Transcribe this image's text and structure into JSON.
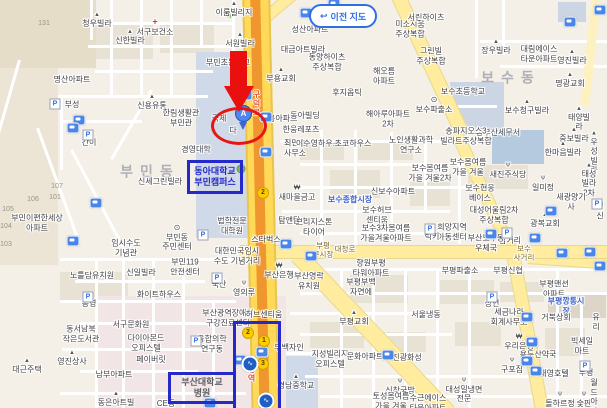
{
  "map": {
    "button": {
      "label": "이전 지도",
      "icon": "undo-arrow"
    },
    "annotations": {
      "marker_letter": "A",
      "box_donga": {
        "text": "동아대학교\n부민캠퍼스"
      },
      "box_hospital": {
        "text": "부산대학교\n병원"
      },
      "road_text_top": "구덕로",
      "road_text_bottom": "토성역"
    },
    "colors": {
      "highlight_blue": "#2629c9",
      "annotation_red": "#e81515",
      "metro_line_orange": "#f0962e",
      "road_yellow": "#ffe87f",
      "market_blue": "#3f63c8",
      "bus_icon_blue": "#4a86e8"
    },
    "labels": [
      {
        "t": "131",
        "x": 44,
        "y": 24,
        "s": "tiny"
      },
      {
        "t": "이룸빌리지",
        "x": 234,
        "y": 9,
        "ic": "villa"
      },
      {
        "t": "청우빌라",
        "x": 97,
        "y": 20,
        "ic": "villa"
      },
      {
        "t": "서구보건소",
        "x": 155,
        "y": 27,
        "ic": "clinic"
      },
      {
        "t": "신한빌라",
        "x": 130,
        "y": 37,
        "ic": "villa"
      },
      {
        "t": "서원빌라",
        "x": 240,
        "y": 40,
        "ic": "villa"
      },
      {
        "t": "성산아파트",
        "x": 310,
        "y": 30
      },
      {
        "t": "대금아트빌라",
        "x": 303,
        "y": 50
      },
      {
        "t": "미소지움\n주상복합",
        "x": 410,
        "y": 29
      },
      {
        "t": "서린하이츠",
        "x": 426,
        "y": 18
      },
      {
        "t": "그린빌\n주상복합",
        "x": 431,
        "y": 56
      },
      {
        "t": "장우빌라",
        "x": 496,
        "y": 47,
        "ic": "villa"
      },
      {
        "t": "대림에이스\n타운아파트",
        "x": 539,
        "y": 54
      },
      {
        "t": "영진빌라",
        "x": 572,
        "y": 57,
        "ic": "villa"
      },
      {
        "t": "동양하이츠\n주상복합",
        "x": 327,
        "y": 62
      },
      {
        "t": "부민초등학교",
        "x": 228,
        "y": 63
      },
      {
        "t": "부용교회",
        "x": 281,
        "y": 75,
        "ic": "villa"
      },
      {
        "t": "명산아파트",
        "x": 72,
        "y": 80
      },
      {
        "t": "해오름\n아파트",
        "x": 384,
        "y": 76
      },
      {
        "t": "보수동",
        "x": 511,
        "y": 78,
        "s": "area"
      },
      {
        "t": "명광교회",
        "x": 570,
        "y": 80,
        "ic": "villa"
      },
      {
        "t": "후지옵틱",
        "x": 347,
        "y": 93
      },
      {
        "t": "보수초등학교",
        "x": 463,
        "y": 92
      },
      {
        "t": "부성",
        "x": 72,
        "y": 105
      },
      {
        "t": "신용유통",
        "x": 152,
        "y": 102,
        "ic": "villa"
      },
      {
        "t": "보수파출소",
        "x": 434,
        "y": 105,
        "ic": "office"
      },
      {
        "t": "보수청구빌라",
        "x": 527,
        "y": 107,
        "ic": "villa"
      },
      {
        "t": "한림생활관\n부민관",
        "x": 181,
        "y": 118
      },
      {
        "t": "국제",
        "x": 219,
        "y": 119
      },
      {
        "t": "부용아파트",
        "x": 279,
        "y": 119
      },
      {
        "t": "동아빌딩",
        "x": 305,
        "y": 116
      },
      {
        "t": "태양빌라",
        "x": 579,
        "y": 119,
        "ic": "villa"
      },
      {
        "t": "해아루아파트\n2차",
        "x": 388,
        "y": 119
      },
      {
        "t": "다",
        "x": 233,
        "y": 131
      },
      {
        "t": "한웅레포츠",
        "x": 301,
        "y": 130
      },
      {
        "t": "중보빌라",
        "x": 574,
        "y": 135,
        "ic": "villa"
      },
      {
        "t": "중부산세무서",
        "x": 498,
        "y": 133
      },
      {
        "t": "송파지오스3\n빌라트주상복합",
        "x": 466,
        "y": 136
      },
      {
        "t": "간이",
        "x": 89,
        "y": 143
      },
      {
        "t": "최만호\n사무소",
        "x": 295,
        "y": 148
      },
      {
        "t": "이수영하우스",
        "x": 318,
        "y": 144
      },
      {
        "t": "초코하우스",
        "x": 353,
        "y": 144
      },
      {
        "t": "노인생활과학\n연구소",
        "x": 411,
        "y": 145
      },
      {
        "t": "한마음빌라",
        "x": 563,
        "y": 149,
        "ic": "villa"
      },
      {
        "t": "경영대학",
        "x": 196,
        "y": 150
      },
      {
        "t": "우성빌라",
        "x": 594,
        "y": 153,
        "ic": "villa"
      },
      {
        "t": "부민동",
        "x": 150,
        "y": 172,
        "s": "area"
      },
      {
        "t": "신세그린빌라",
        "x": 160,
        "y": 182
      },
      {
        "t": "보수봄여름\n가을 겨울2차",
        "x": 430,
        "y": 173
      },
      {
        "t": "보수봄여름\n가을 겨울",
        "x": 468,
        "y": 167
      },
      {
        "t": "새진주식당",
        "x": 508,
        "y": 171,
        "ic": "rest"
      },
      {
        "t": "태성빌라2차",
        "x": 589,
        "y": 180,
        "ic": "villa"
      },
      {
        "t": "일미정",
        "x": 543,
        "y": 184,
        "ic": "rest"
      },
      {
        "t": "새마을금고",
        "x": 297,
        "y": 193,
        "ic": "bank"
      },
      {
        "t": "신보수아파트",
        "x": 393,
        "y": 192
      },
      {
        "t": "보수현웅\n베이스",
        "x": 480,
        "y": 193
      },
      {
        "t": "보수종합시장",
        "x": 350,
        "y": 200,
        "s": "blue"
      },
      {
        "t": "새광양기사",
        "x": 571,
        "y": 202
      },
      {
        "t": "청신",
        "x": 600,
        "y": 211
      },
      {
        "t": "보수허브\n센티움",
        "x": 377,
        "y": 215
      },
      {
        "t": "대성어울림2차\n주상복합",
        "x": 494,
        "y": 215
      },
      {
        "t": "탐앤탐스",
        "x": 293,
        "y": 221
      },
      {
        "t": "광복교회",
        "x": 545,
        "y": 220,
        "ic": "villa"
      },
      {
        "t": "법학전문\n대학원",
        "x": 232,
        "y": 226
      },
      {
        "t": "브리지스톤\n타이어",
        "x": 314,
        "y": 227
      },
      {
        "t": "부민이편한세상\n아파트",
        "x": 37,
        "y": 223
      },
      {
        "t": "107",
        "x": 57,
        "y": 187,
        "s": "tiny"
      },
      {
        "t": "101",
        "x": 55,
        "y": 198,
        "s": "tiny"
      },
      {
        "t": "106",
        "x": 33,
        "y": 200,
        "s": "tiny"
      },
      {
        "t": "105",
        "x": 8,
        "y": 210,
        "s": "tiny"
      },
      {
        "t": "104",
        "x": 6,
        "y": 227,
        "s": "tiny"
      },
      {
        "t": "103",
        "x": 6,
        "y": 245,
        "s": "tiny"
      },
      {
        "t": "보수3차봄여름\n가을겨울아파트",
        "x": 386,
        "y": 233
      },
      {
        "t": "희망지역\n아동센터",
        "x": 452,
        "y": 232
      },
      {
        "t": "럭키",
        "x": 432,
        "y": 237
      },
      {
        "t": "부민동\n주민센터",
        "x": 177,
        "y": 238,
        "ic": "office"
      },
      {
        "t": "삼거리",
        "x": 510,
        "y": 241
      },
      {
        "t": "스타벅스",
        "x": 266,
        "y": 240
      },
      {
        "t": "부산보수동\n우체국",
        "x": 486,
        "y": 243
      },
      {
        "t": "대청로",
        "x": 345,
        "y": 249,
        "s": "road"
      },
      {
        "t": "부평\n구시장",
        "x": 323,
        "y": 250,
        "s": "road"
      },
      {
        "t": "임시수도\n기념관",
        "x": 126,
        "y": 248
      },
      {
        "t": "보수\n사거리",
        "x": 524,
        "y": 253,
        "s": "road"
      },
      {
        "t": "대한민국임시\n수도 기념거리",
        "x": 237,
        "y": 256
      },
      {
        "t": "향원부평\n타워아파트",
        "x": 371,
        "y": 268
      },
      {
        "t": "부민119\n안전센터",
        "x": 185,
        "y": 267
      },
      {
        "t": "부산은행",
        "x": 279,
        "y": 271,
        "ic": "bank"
      },
      {
        "t": "부평파출소",
        "x": 460,
        "y": 271
      },
      {
        "t": "부평신협",
        "x": 508,
        "y": 271
      },
      {
        "t": "노틀담유치원",
        "x": 92,
        "y": 276
      },
      {
        "t": "신일빌라",
        "x": 141,
        "y": 273
      },
      {
        "t": "부산영락\n유치원",
        "x": 309,
        "y": 281
      },
      {
        "t": "국산",
        "x": 219,
        "y": 285
      },
      {
        "t": "영의루",
        "x": 244,
        "y": 289,
        "ic": "rest"
      },
      {
        "t": "부평부백\n자연에",
        "x": 361,
        "y": 287
      },
      {
        "t": "부평맨션\n아파트",
        "x": 554,
        "y": 289
      },
      {
        "t": "화이트하우스",
        "x": 159,
        "y": 295
      },
      {
        "t": "공영",
        "x": 89,
        "y": 304
      },
      {
        "t": "상언",
        "x": 492,
        "y": 304
      },
      {
        "t": "부평깡통시장",
        "x": 566,
        "y": 306,
        "s": "blue"
      },
      {
        "t": "부산광역장애인\n구강진료센터",
        "x": 228,
        "y": 318
      },
      {
        "t": "허브센티움",
        "x": 264,
        "y": 315
      },
      {
        "t": "부평교회",
        "x": 354,
        "y": 318,
        "ic": "villa"
      },
      {
        "t": "서울냉동",
        "x": 426,
        "y": 315
      },
      {
        "t": "세금나라\n회계사무소",
        "x": 509,
        "y": 317
      },
      {
        "t": "거북상회",
        "x": 556,
        "y": 318
      },
      {
        "t": "유리",
        "x": 596,
        "y": 322
      },
      {
        "t": "서구문화원",
        "x": 131,
        "y": 325
      },
      {
        "t": "동서남북\n작은도서관",
        "x": 81,
        "y": 334
      },
      {
        "t": "다이아몬드\n오피스텔",
        "x": 146,
        "y": 343
      },
      {
        "t": "융합의학\n연구동",
        "x": 212,
        "y": 344
      },
      {
        "t": "부백자인",
        "x": 289,
        "y": 348
      },
      {
        "t": "우리은행",
        "x": 519,
        "y": 342,
        "ic": "bank"
      },
      {
        "t": "빅세일마트",
        "x": 582,
        "y": 346
      },
      {
        "t": "영진상사",
        "x": 72,
        "y": 358,
        "ic": "villa"
      },
      {
        "t": "페이버릿",
        "x": 151,
        "y": 360
      },
      {
        "t": "지성빌리지\n오피스텔",
        "x": 330,
        "y": 359
      },
      {
        "t": "문화아파트",
        "x": 365,
        "y": 357
      },
      {
        "t": "진광화성",
        "x": 407,
        "y": 358
      },
      {
        "t": "용두산약국",
        "x": 538,
        "y": 355
      },
      {
        "t": "구포집",
        "x": 512,
        "y": 366,
        "ic": "rest"
      },
      {
        "t": "남부아파트",
        "x": 114,
        "y": 375
      },
      {
        "t": "대근주택",
        "x": 27,
        "y": 366,
        "ic": "villa"
      },
      {
        "t": "대영호텔",
        "x": 554,
        "y": 374
      },
      {
        "t": "부평",
        "x": 586,
        "y": 373
      },
      {
        "t": "경남중학교",
        "x": 296,
        "y": 382,
        "ic": "villa"
      },
      {
        "t": "신창국밥",
        "x": 400,
        "y": 387,
        "ic": "rest"
      },
      {
        "t": "대성밀냉면\n전문",
        "x": 464,
        "y": 391,
        "ic": "rest"
      },
      {
        "t": "동은아트빌",
        "x": 116,
        "y": 399,
        "ic": "villa"
      },
      {
        "t": "CE동",
        "x": 166,
        "y": 404
      },
      {
        "t": "토성봄여름\n가을 겨울",
        "x": 391,
        "y": 401
      },
      {
        "t": "수근에이스\n타운아파트",
        "x": 428,
        "y": 403
      },
      {
        "t": "돌하르정",
        "x": 560,
        "y": 400,
        "ic": "rest"
      },
      {
        "t": "숯판",
        "x": 584,
        "y": 400,
        "ic": "rest"
      },
      {
        "t": "월드\n아파트",
        "x": 594,
        "y": 402
      }
    ],
    "icons": {
      "bus_stops": [
        [
          306,
          13
        ],
        [
          334,
          4
        ],
        [
          570,
          22
        ],
        [
          600,
          10
        ],
        [
          246,
          95
        ],
        [
          266,
          117
        ],
        [
          266,
          152
        ],
        [
          79,
          120
        ],
        [
          73,
          128
        ],
        [
          96,
          203
        ],
        [
          73,
          241
        ],
        [
          286,
          244
        ],
        [
          311,
          256
        ],
        [
          491,
          234
        ],
        [
          535,
          238
        ],
        [
          590,
          252
        ],
        [
          551,
          211
        ],
        [
          562,
          253
        ],
        [
          600,
          266
        ],
        [
          388,
          355
        ],
        [
          527,
          317
        ],
        [
          532,
          342
        ],
        [
          536,
          371
        ],
        [
          262,
          352
        ],
        [
          240,
          360
        ],
        [
          210,
          403
        ],
        [
          527,
          361
        ]
      ],
      "parking": [
        [
          55,
          104
        ],
        [
          88,
          135
        ],
        [
          88,
          297
        ],
        [
          217,
          278
        ],
        [
          203,
          235
        ],
        [
          196,
          341
        ],
        [
          430,
          229
        ],
        [
          492,
          297
        ],
        [
          507,
          233
        ],
        [
          597,
          204
        ],
        [
          585,
          366
        ]
      ],
      "subway_exits": [
        {
          "n": "2",
          "x": 263,
          "y": 193
        },
        {
          "n": "2",
          "x": 248,
          "y": 333
        },
        {
          "n": "1",
          "x": 264,
          "y": 341
        },
        {
          "n": "3",
          "x": 263,
          "y": 364
        }
      ],
      "metro_stations": [
        [
          250,
          364
        ],
        [
          266,
          401
        ]
      ],
      "trees": [
        [
          241,
          169
        ],
        [
          230,
          13
        ]
      ]
    }
  }
}
